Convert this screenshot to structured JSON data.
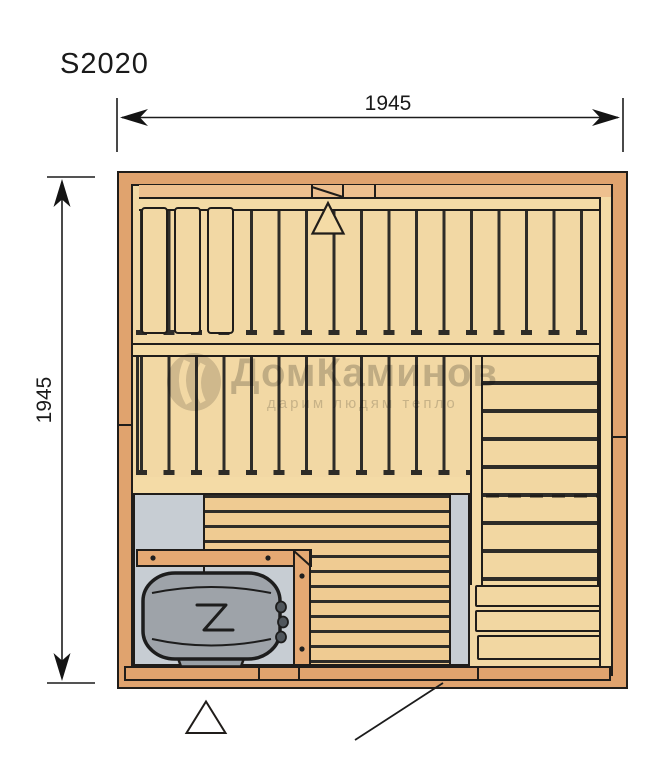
{
  "title": "S2020",
  "dimension_top": {
    "label": "1945"
  },
  "dimension_left": {
    "label": "1945"
  },
  "watermark": {
    "brand": "ДомКаминов",
    "tagline": "дарим людям тепло"
  },
  "symbols": {
    "vent_top": "triangle-outline",
    "vent_bottom": "triangle-outline",
    "door_indicator": "diagonal-leader-line",
    "heater_element": "zigzag"
  },
  "colors": {
    "wall": "#e0a36e",
    "panel": "#f2d8a4",
    "ledge": "#eec08f",
    "duckboard": "#efcb92",
    "bench": "#f2d7a2",
    "floor_gray": "#c7cdd3",
    "heater_gray": "#9ea3a9",
    "outline": "#201d1a",
    "watermark_gray": "#9b9b9b",
    "background": "#ffffff"
  }
}
